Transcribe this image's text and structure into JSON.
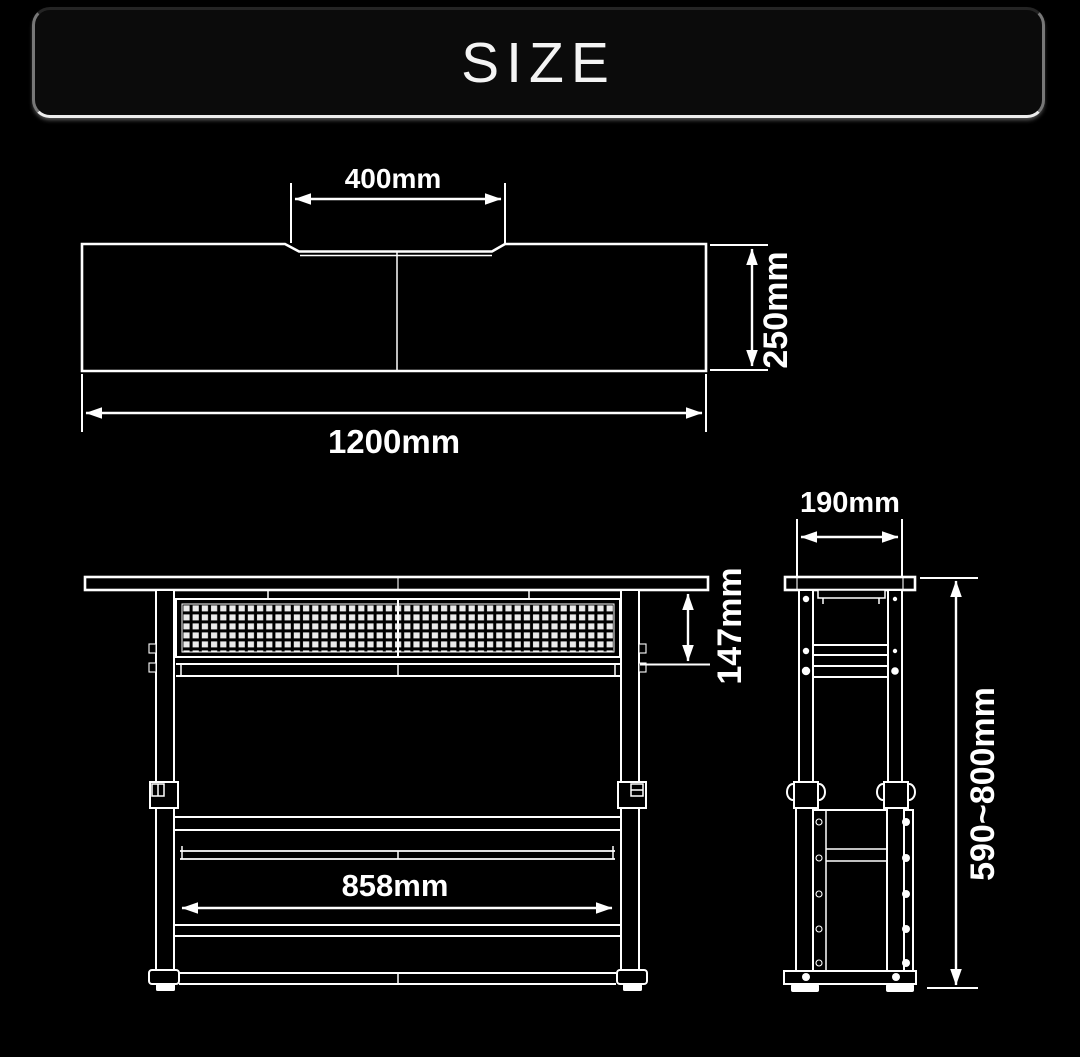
{
  "title": "SIZE",
  "colors": {
    "background": "#000000",
    "line": "#ffffff",
    "label": "#ffffff"
  },
  "dimensions": {
    "top_view": {
      "tray_width": "400mm",
      "depth": "250mm",
      "total_width": "1200mm"
    },
    "front_view": {
      "under_panel_height": "147mm",
      "inner_width": "858mm"
    },
    "side_view": {
      "depth": "190mm",
      "height_range": "590~800mm"
    }
  }
}
